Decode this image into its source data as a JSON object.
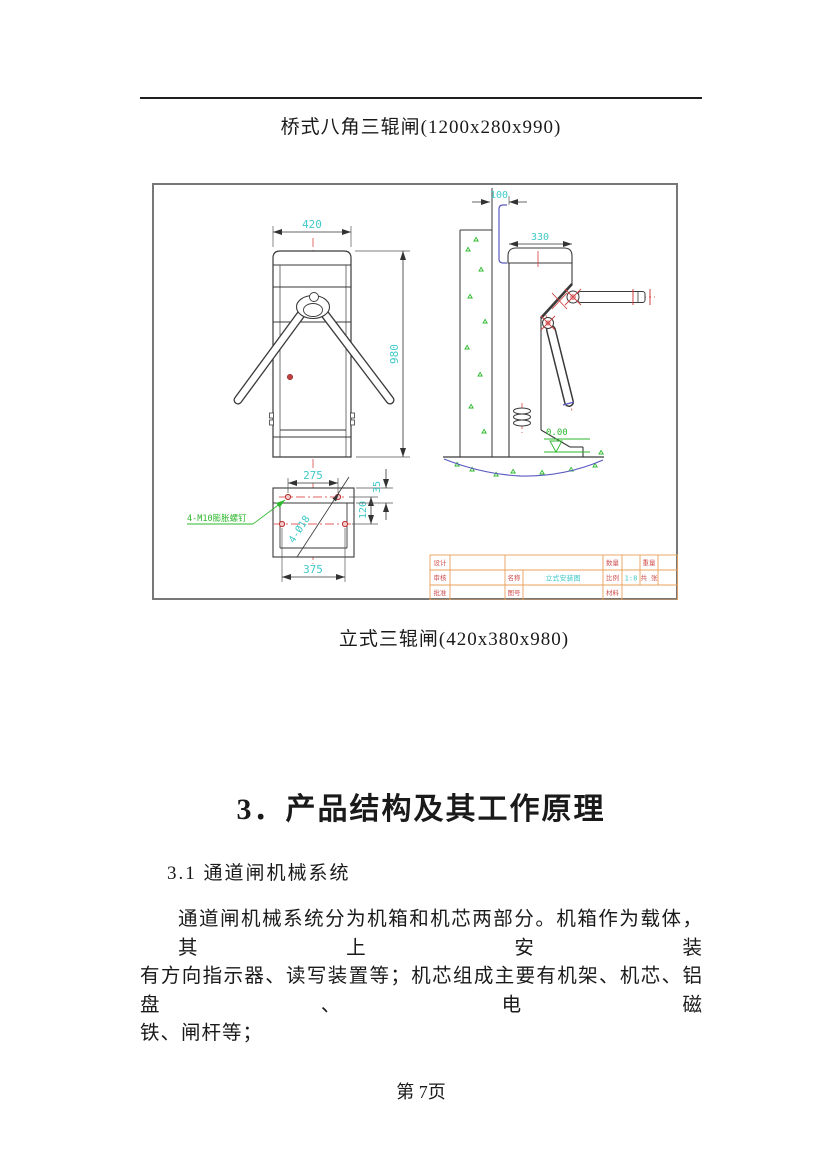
{
  "document": {
    "title": "桥式八角三辊闸(1200x280x990)",
    "caption": "立式三辊闸(420x380x980)",
    "section_heading": "3．产品结构及其工作原理",
    "subsection_heading": "3.1 通道闸机械系统",
    "paragraph_lines": [
      "通道闸机械系统分为机箱和机芯两部分。机箱作为载体，其上安装",
      "有方向指示器、读写装置等；机芯组成主要有机架、机芯、铝盘、电磁",
      "铁、闸杆等；"
    ],
    "page_footer": "第 7页"
  },
  "drawing": {
    "dims": {
      "front_width": "420",
      "front_height": "980",
      "plate_hole_span": "275",
      "plate_width": "375",
      "plate_hole_pitch": "120",
      "plate_edge_offset": "35",
      "wall_gap": "100",
      "cabinet_depth": "330",
      "hole_spec": "4-Ø18",
      "anchor_note": "4-M10膨胀螺钉",
      "ground_level": "0.00"
    },
    "title_block": {
      "design": "设计",
      "review": "审核",
      "approve": "批准",
      "name": "名称",
      "name_value": "立式安装图",
      "drawing_no": "图号",
      "quantity": "数量",
      "scale": "比例",
      "scale_value": "1:8",
      "material": "材料",
      "weight": "重量",
      "sheets": "共 张"
    },
    "colors": {
      "dimension_text": "#3fc8c8",
      "centerline_red": "#e06060",
      "annotation_green": "#2db82d",
      "table_line": "#e8a05a",
      "table_label": "#d05050",
      "drawing_line": "#3a3a3a",
      "ground_blue": "#5a5ac0"
    }
  }
}
